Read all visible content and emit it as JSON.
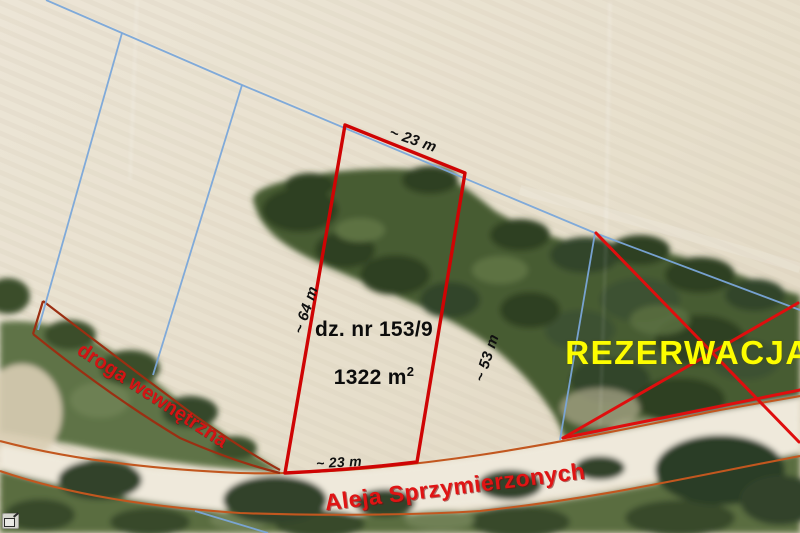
{
  "parcel": {
    "number": "dz. nr 153/9",
    "area_value": "1322 m",
    "area_exponent": "2"
  },
  "dimensions": {
    "top_width": "~ 23 m",
    "left_length": "~ 64 m",
    "right_length": "~ 53 m",
    "bottom_width": "~ 23 m"
  },
  "roads": {
    "street_name": "Aleja Sprzymierzonych",
    "internal_road": "droga wewnętrzna"
  },
  "status": {
    "reservation": "REZERWACJA"
  },
  "colors": {
    "parcel_outline": "#cf0404",
    "reservation_cross": "#df0e0e",
    "boundary_line": "#7aa6d9",
    "road_outline": "#c2571f",
    "internal_road_outline": "#9b2f12",
    "street_label": "#e01414",
    "internal_road_label": "#d41414",
    "reservation_label": "#fdfd00",
    "measurement_label": "#101010"
  }
}
